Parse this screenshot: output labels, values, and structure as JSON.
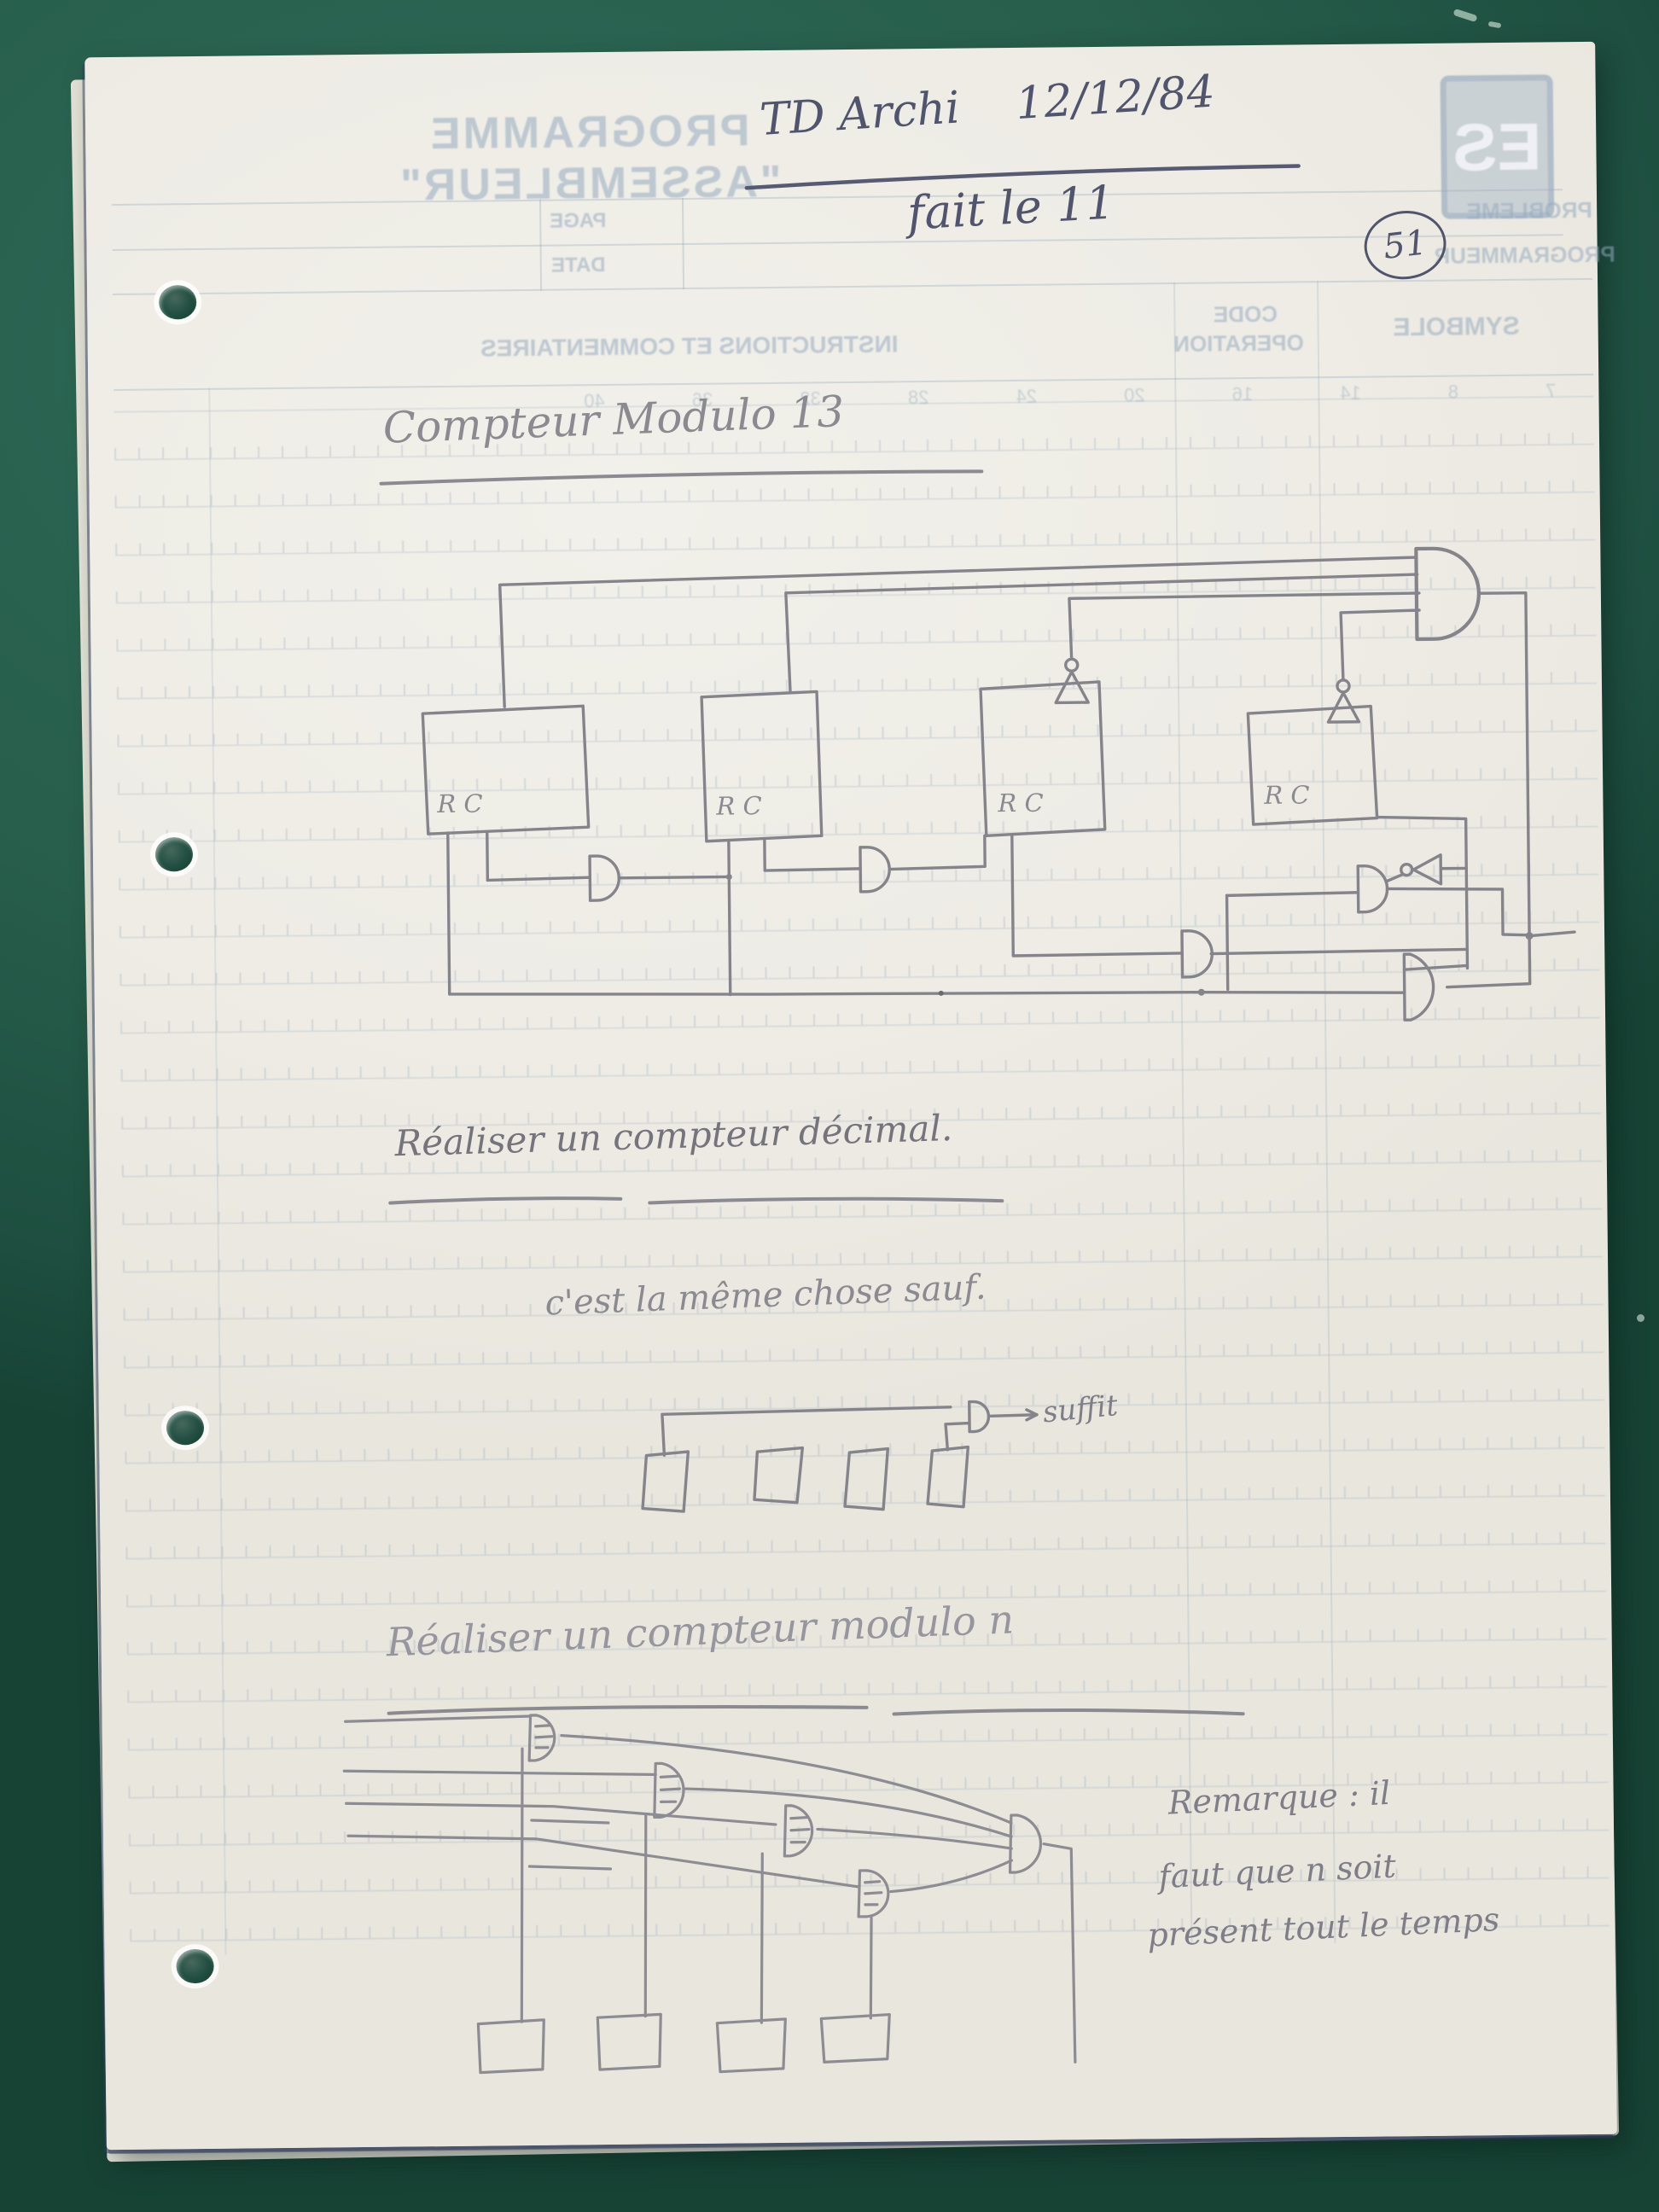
{
  "colors": {
    "desk_green": "#2a6452",
    "paper": "#efede6",
    "ink_blue": "#50546c",
    "pencil_gray": "#8b8a91",
    "print_blue": "#9fb4c8"
  },
  "handwritten_header": {
    "course": "TD Archi",
    "date": "12/12/84",
    "note": "fait le 11",
    "page_number": "51"
  },
  "printed_form": {
    "mirrored": true,
    "logo": "ES",
    "title": "PROGRAMME \"ASSEMBLEUR\"",
    "field_problem": "PROBLEME",
    "field_page": "PAGE",
    "field_programmer": "PROGRAMMEUR",
    "field_date": "DATE",
    "col_symbol": "SYMBOLE",
    "col_opcode_line1": "CODE",
    "col_opcode_line2": "OPERATION",
    "col_instructions": "INSTRUCTIONS ET COMMENTAIRES",
    "column_numbers": "7 8 14 16 20 24 28 32 36 40"
  },
  "notes": {
    "title_modulo13": "Compteur Modulo 13",
    "rc_label": "R C",
    "task_decimal": "Réaliser un compteur décimal.",
    "same_thing": "c'est la même chose sauf.",
    "suffit": "suffit",
    "task_modulo_n": "Réaliser un compteur modulo n",
    "remark_line1": "Remarque : il",
    "remark_line2": "faut que n soit",
    "remark_line3": "présent tout le temps"
  }
}
